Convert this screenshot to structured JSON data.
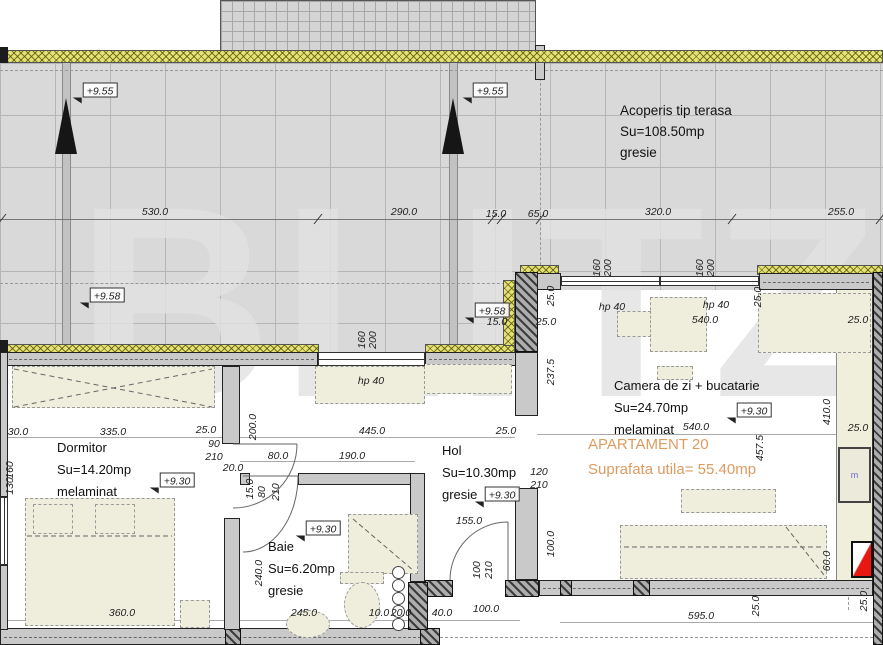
{
  "watermark": "BLITZ",
  "colors": {
    "accent_orange": "#DE9B60",
    "terrace_gray": "#D9D9D9",
    "parapet_yellow": "#E6E173",
    "wall_gray": "#C9C9C9",
    "furniture_beige": "#EFEEDD",
    "section_marker_red": "#E8170F",
    "fixture_blue": "#6A6AD0"
  },
  "roof": {
    "title": "Acoperis tip terasa",
    "area": "Su=108.50mp",
    "finish": "gresie"
  },
  "apartment": {
    "name": "APARTAMENT 20",
    "usable_area": "Suprafata utila= 55.40mp"
  },
  "rooms": [
    {
      "name": "Dormitor",
      "area": "Su=14.20mp",
      "finish": "melaminat"
    },
    {
      "name": "Baie",
      "area": "Su=6.20mp",
      "finish": "gresie"
    },
    {
      "name": "Hol",
      "area": "Su=10.30mp",
      "finish": "gresie"
    },
    {
      "name": "Camera de zi + bucatarie",
      "area": "Su=24.70mp",
      "finish": "melaminat"
    }
  ],
  "fixtures": {
    "meter_label": "m"
  },
  "level_markers": [
    {
      "t": "+9.55",
      "x": 100,
      "y": 90
    },
    {
      "t": "+9.55",
      "x": 490,
      "y": 90
    },
    {
      "t": "+9.58",
      "x": 107,
      "y": 295
    },
    {
      "t": "+9.58",
      "x": 492,
      "y": 310
    },
    {
      "t": "+9.30",
      "x": 177,
      "y": 480
    },
    {
      "t": "+9.30",
      "x": 502,
      "y": 494
    },
    {
      "t": "+9.30",
      "x": 323,
      "y": 528
    },
    {
      "t": "+9.30",
      "x": 754,
      "y": 410
    }
  ],
  "dim_labels": [
    {
      "t": "530.0",
      "x": 155,
      "y": 212
    },
    {
      "t": "290.0",
      "x": 404,
      "y": 212
    },
    {
      "t": "15.0",
      "x": 496,
      "y": 214
    },
    {
      "t": "65.0",
      "x": 538,
      "y": 214
    },
    {
      "t": "320.0",
      "x": 658,
      "y": 212
    },
    {
      "t": "255.0",
      "x": 841,
      "y": 212
    },
    {
      "t": "15.0",
      "x": 497,
      "y": 322
    },
    {
      "t": "25.0",
      "x": 546,
      "y": 322
    },
    {
      "t": "25.0",
      "x": 551,
      "y": 296,
      "r": 1
    },
    {
      "t": "237.5",
      "x": 551,
      "y": 372,
      "r": 1
    },
    {
      "t": "25.0",
      "x": 858,
      "y": 320
    },
    {
      "t": "160",
      "x": 597,
      "y": 268,
      "r": 1
    },
    {
      "t": "200",
      "x": 608,
      "y": 268,
      "r": 1
    },
    {
      "t": "160",
      "x": 700,
      "y": 268,
      "r": 1
    },
    {
      "t": "200",
      "x": 711,
      "y": 268,
      "r": 1
    },
    {
      "t": "hp 40",
      "x": 612,
      "y": 307
    },
    {
      "t": "hp 40",
      "x": 716,
      "y": 305
    },
    {
      "t": "540.0",
      "x": 705,
      "y": 320
    },
    {
      "t": "25.0",
      "x": 758,
      "y": 297,
      "r": 1
    },
    {
      "t": "160",
      "x": 362,
      "y": 340,
      "r": 1
    },
    {
      "t": "200",
      "x": 373,
      "y": 340,
      "r": 1
    },
    {
      "t": "hp 40",
      "x": 371,
      "y": 381
    },
    {
      "t": "30.0",
      "x": 18,
      "y": 432
    },
    {
      "t": "335.0",
      "x": 113,
      "y": 432
    },
    {
      "t": "25.0",
      "x": 206,
      "y": 430
    },
    {
      "t": "90",
      "x": 214,
      "y": 444
    },
    {
      "t": "210",
      "x": 214,
      "y": 457
    },
    {
      "t": "20.0",
      "x": 233,
      "y": 468
    },
    {
      "t": "200.0",
      "x": 253,
      "y": 427,
      "r": 1
    },
    {
      "t": "445.0",
      "x": 372,
      "y": 431
    },
    {
      "t": "25.0",
      "x": 506,
      "y": 431
    },
    {
      "t": "540.0",
      "x": 696,
      "y": 427
    },
    {
      "t": "410.0",
      "x": 827,
      "y": 412,
      "r": 1
    },
    {
      "t": "457.5",
      "x": 760,
      "y": 448,
      "r": 1
    },
    {
      "t": "25.0",
      "x": 858,
      "y": 428
    },
    {
      "t": "80.0",
      "x": 278,
      "y": 456
    },
    {
      "t": "190.0",
      "x": 352,
      "y": 456
    },
    {
      "t": "15.0",
      "x": 250,
      "y": 489,
      "r": 1
    },
    {
      "t": "80",
      "x": 262,
      "y": 492,
      "r": 1
    },
    {
      "t": "210",
      "x": 276,
      "y": 492,
      "r": 1
    },
    {
      "t": "120",
      "x": 539,
      "y": 472
    },
    {
      "t": "210",
      "x": 539,
      "y": 485
    },
    {
      "t": "155.0",
      "x": 469,
      "y": 521
    },
    {
      "t": "100",
      "x": 477,
      "y": 570,
      "r": 1
    },
    {
      "t": "210",
      "x": 489,
      "y": 570,
      "r": 1
    },
    {
      "t": "100.0",
      "x": 551,
      "y": 544,
      "r": 1
    },
    {
      "t": "160",
      "x": 10,
      "y": 470,
      "r": 1
    },
    {
      "t": "130",
      "x": 10,
      "y": 486,
      "r": 1
    },
    {
      "t": "240.0",
      "x": 259,
      "y": 573,
      "r": 1
    },
    {
      "t": "360.0",
      "x": 122,
      "y": 613
    },
    {
      "t": "245.0",
      "x": 304,
      "y": 613
    },
    {
      "t": "10.0",
      "x": 379,
      "y": 613
    },
    {
      "t": "20.0",
      "x": 401,
      "y": 613
    },
    {
      "t": "40.0",
      "x": 442,
      "y": 613
    },
    {
      "t": "100.0",
      "x": 486,
      "y": 609
    },
    {
      "t": "595.0",
      "x": 701,
      "y": 616
    },
    {
      "t": "25.0",
      "x": 756,
      "y": 606,
      "r": 1
    },
    {
      "t": "60.0",
      "x": 827,
      "y": 561,
      "r": 1
    },
    {
      "t": "25.0",
      "x": 864,
      "y": 601,
      "r": 1
    }
  ]
}
